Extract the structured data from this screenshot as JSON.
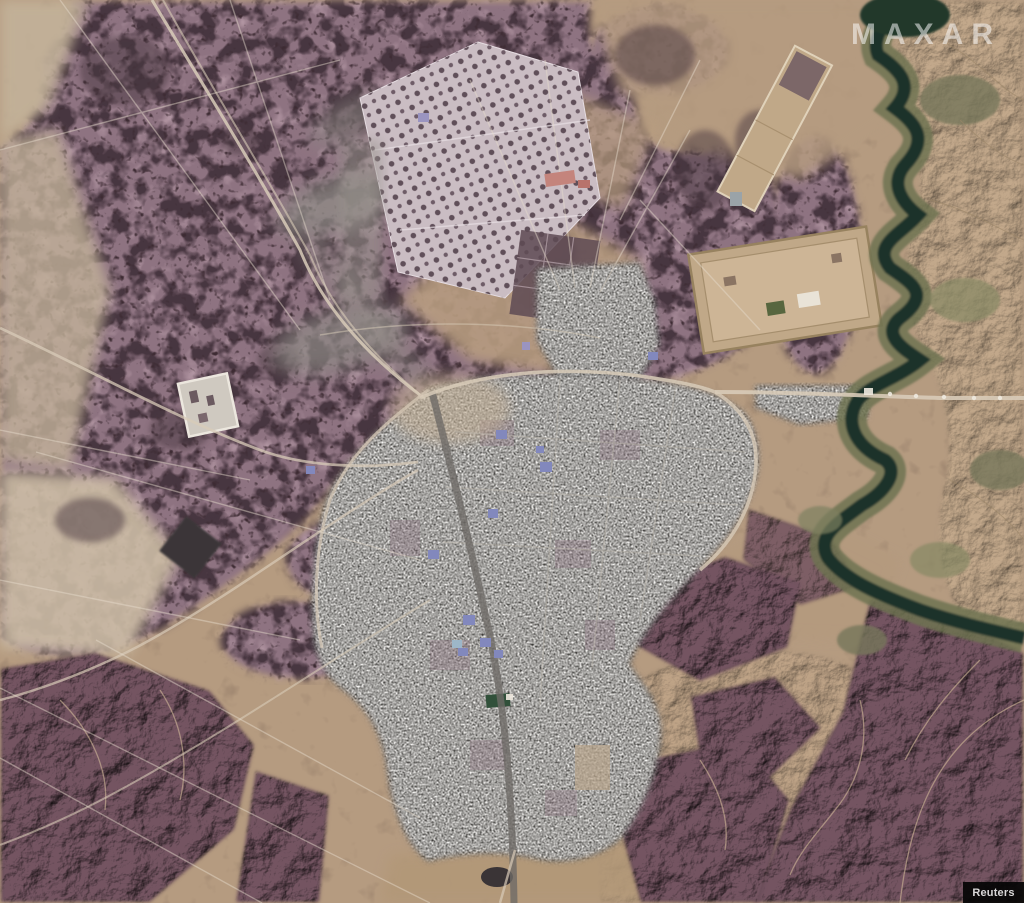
{
  "window": {
    "width_px": 1024,
    "height_px": 903
  },
  "image": {
    "kind": "satellite-photograph",
    "description": "Overhead Maxar satellite view of a desert town with a gray street grid, bordered on the east by a dark green meandering river, mauve speckled scrubland, tan tracks, walled compounds and an orchard field to the north, and maroon eroded hills to the southeast."
  },
  "watermarks": {
    "maxar": "MAXAR",
    "reuters": "Reuters"
  },
  "colors": {
    "sand_base": "#b59b80",
    "sand_light": "#cdbda6",
    "terrain_mauve": "#8e7381",
    "terrain_mauve_light": "#b09aa4",
    "speckle_dark": "#43323d",
    "hills_maroon": "#6b4e5a",
    "city_gray": "#8f8c87",
    "highway_gray": "#6e6a66",
    "river_green_dark": "#1c332a",
    "vegetation_olive": "#6f7352",
    "road_light": "#d8cbb8",
    "roof_blue": "#8288bd",
    "roof_red": "#c4847c",
    "smoke_gray": "#8f8b86",
    "field_pale": "#cabdc3",
    "compound_tan": "#c0a888",
    "credit_bg": "#050505",
    "credit_text": "#e2e2e2"
  }
}
